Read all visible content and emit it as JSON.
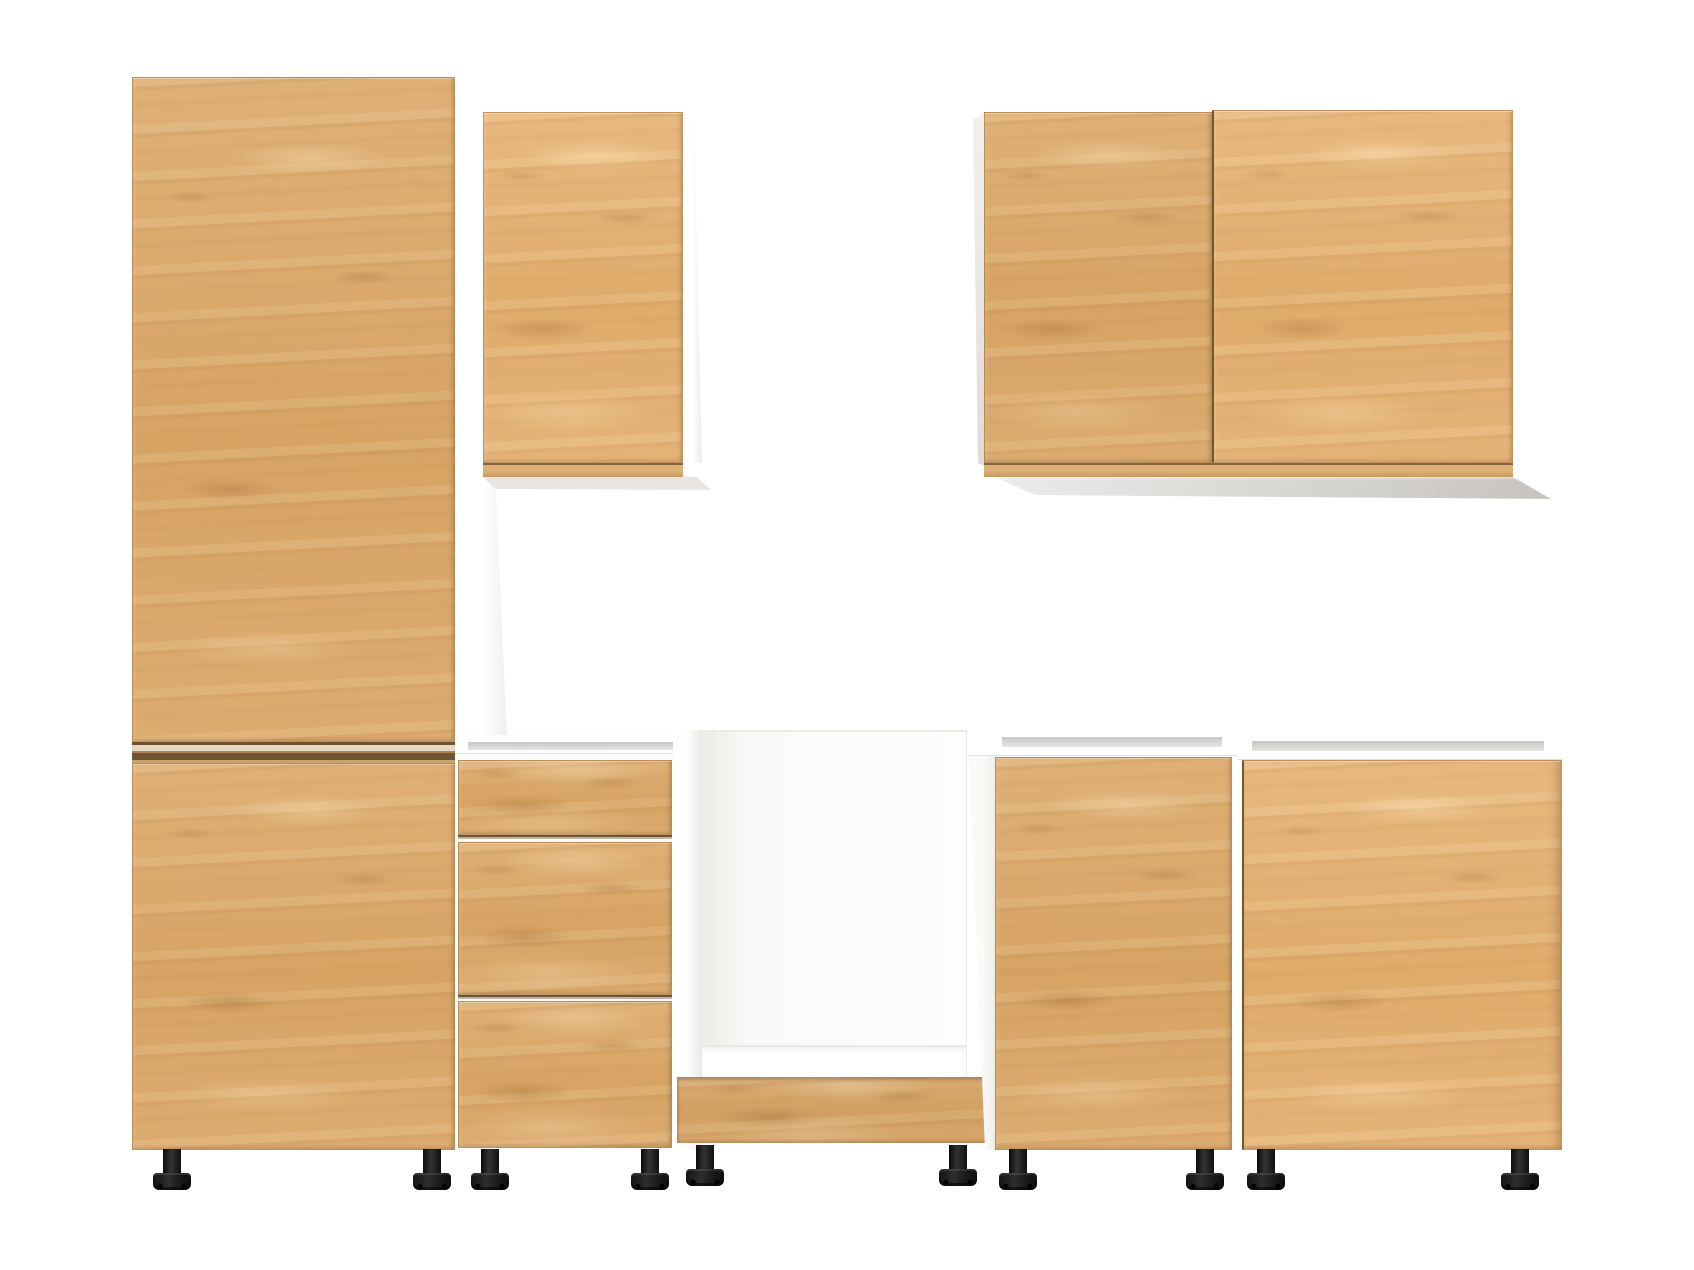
{
  "scene": {
    "type": "product-render",
    "subject": "modular kitchen cabinet set with light oak fronts and white carcasses, front view on plain white background",
    "text_visible": "none"
  },
  "colors": {
    "background": "#ffffff",
    "wood": "#d9a76b",
    "wood_light": "#ecd0a0",
    "wood_dark": "#b98a52",
    "wood_edge": "#6f5331",
    "carcass": "#ffffff",
    "carcass_shade": "#e9e7e4",
    "slot_gray": "#d8d6d3",
    "feet_black": "#1a1a1a",
    "shadow_gray": "#d9d6d2"
  },
  "units": [
    {
      "id": "tall-cabinet",
      "label": "tall housing cabinet with two doors",
      "doors": 2,
      "feet": 2
    },
    {
      "id": "wall-cabinet-single",
      "label": "single-door wall cabinet (left group)",
      "doors": 1,
      "feet": 0
    },
    {
      "id": "drawer-base-unit",
      "label": "base unit with three drawers, open top",
      "drawers": 3,
      "feet": 2
    },
    {
      "id": "oven-housing-base",
      "label": "open oven housing base unit with wood plinth",
      "doors": 0,
      "feet": 2
    },
    {
      "id": "wall-cabinet-double",
      "label": "double-door wall cabinet (right group)",
      "doors": 2,
      "feet": 0
    },
    {
      "id": "base-cabinet-narrow",
      "label": "narrow single-door base cabinet, open top",
      "doors": 1,
      "feet": 2
    },
    {
      "id": "base-cabinet-wide",
      "label": "wide single-door base cabinet, open top",
      "doors": 1,
      "feet": 2
    }
  ],
  "counts": {
    "total_doors": 7,
    "total_drawers": 3,
    "total_feet": 10,
    "plinths": 1
  },
  "materials": {
    "fronts": "light oak / beech wood decor, horizontal grain",
    "carcass": "white",
    "feet": "black plastic adjustable"
  }
}
